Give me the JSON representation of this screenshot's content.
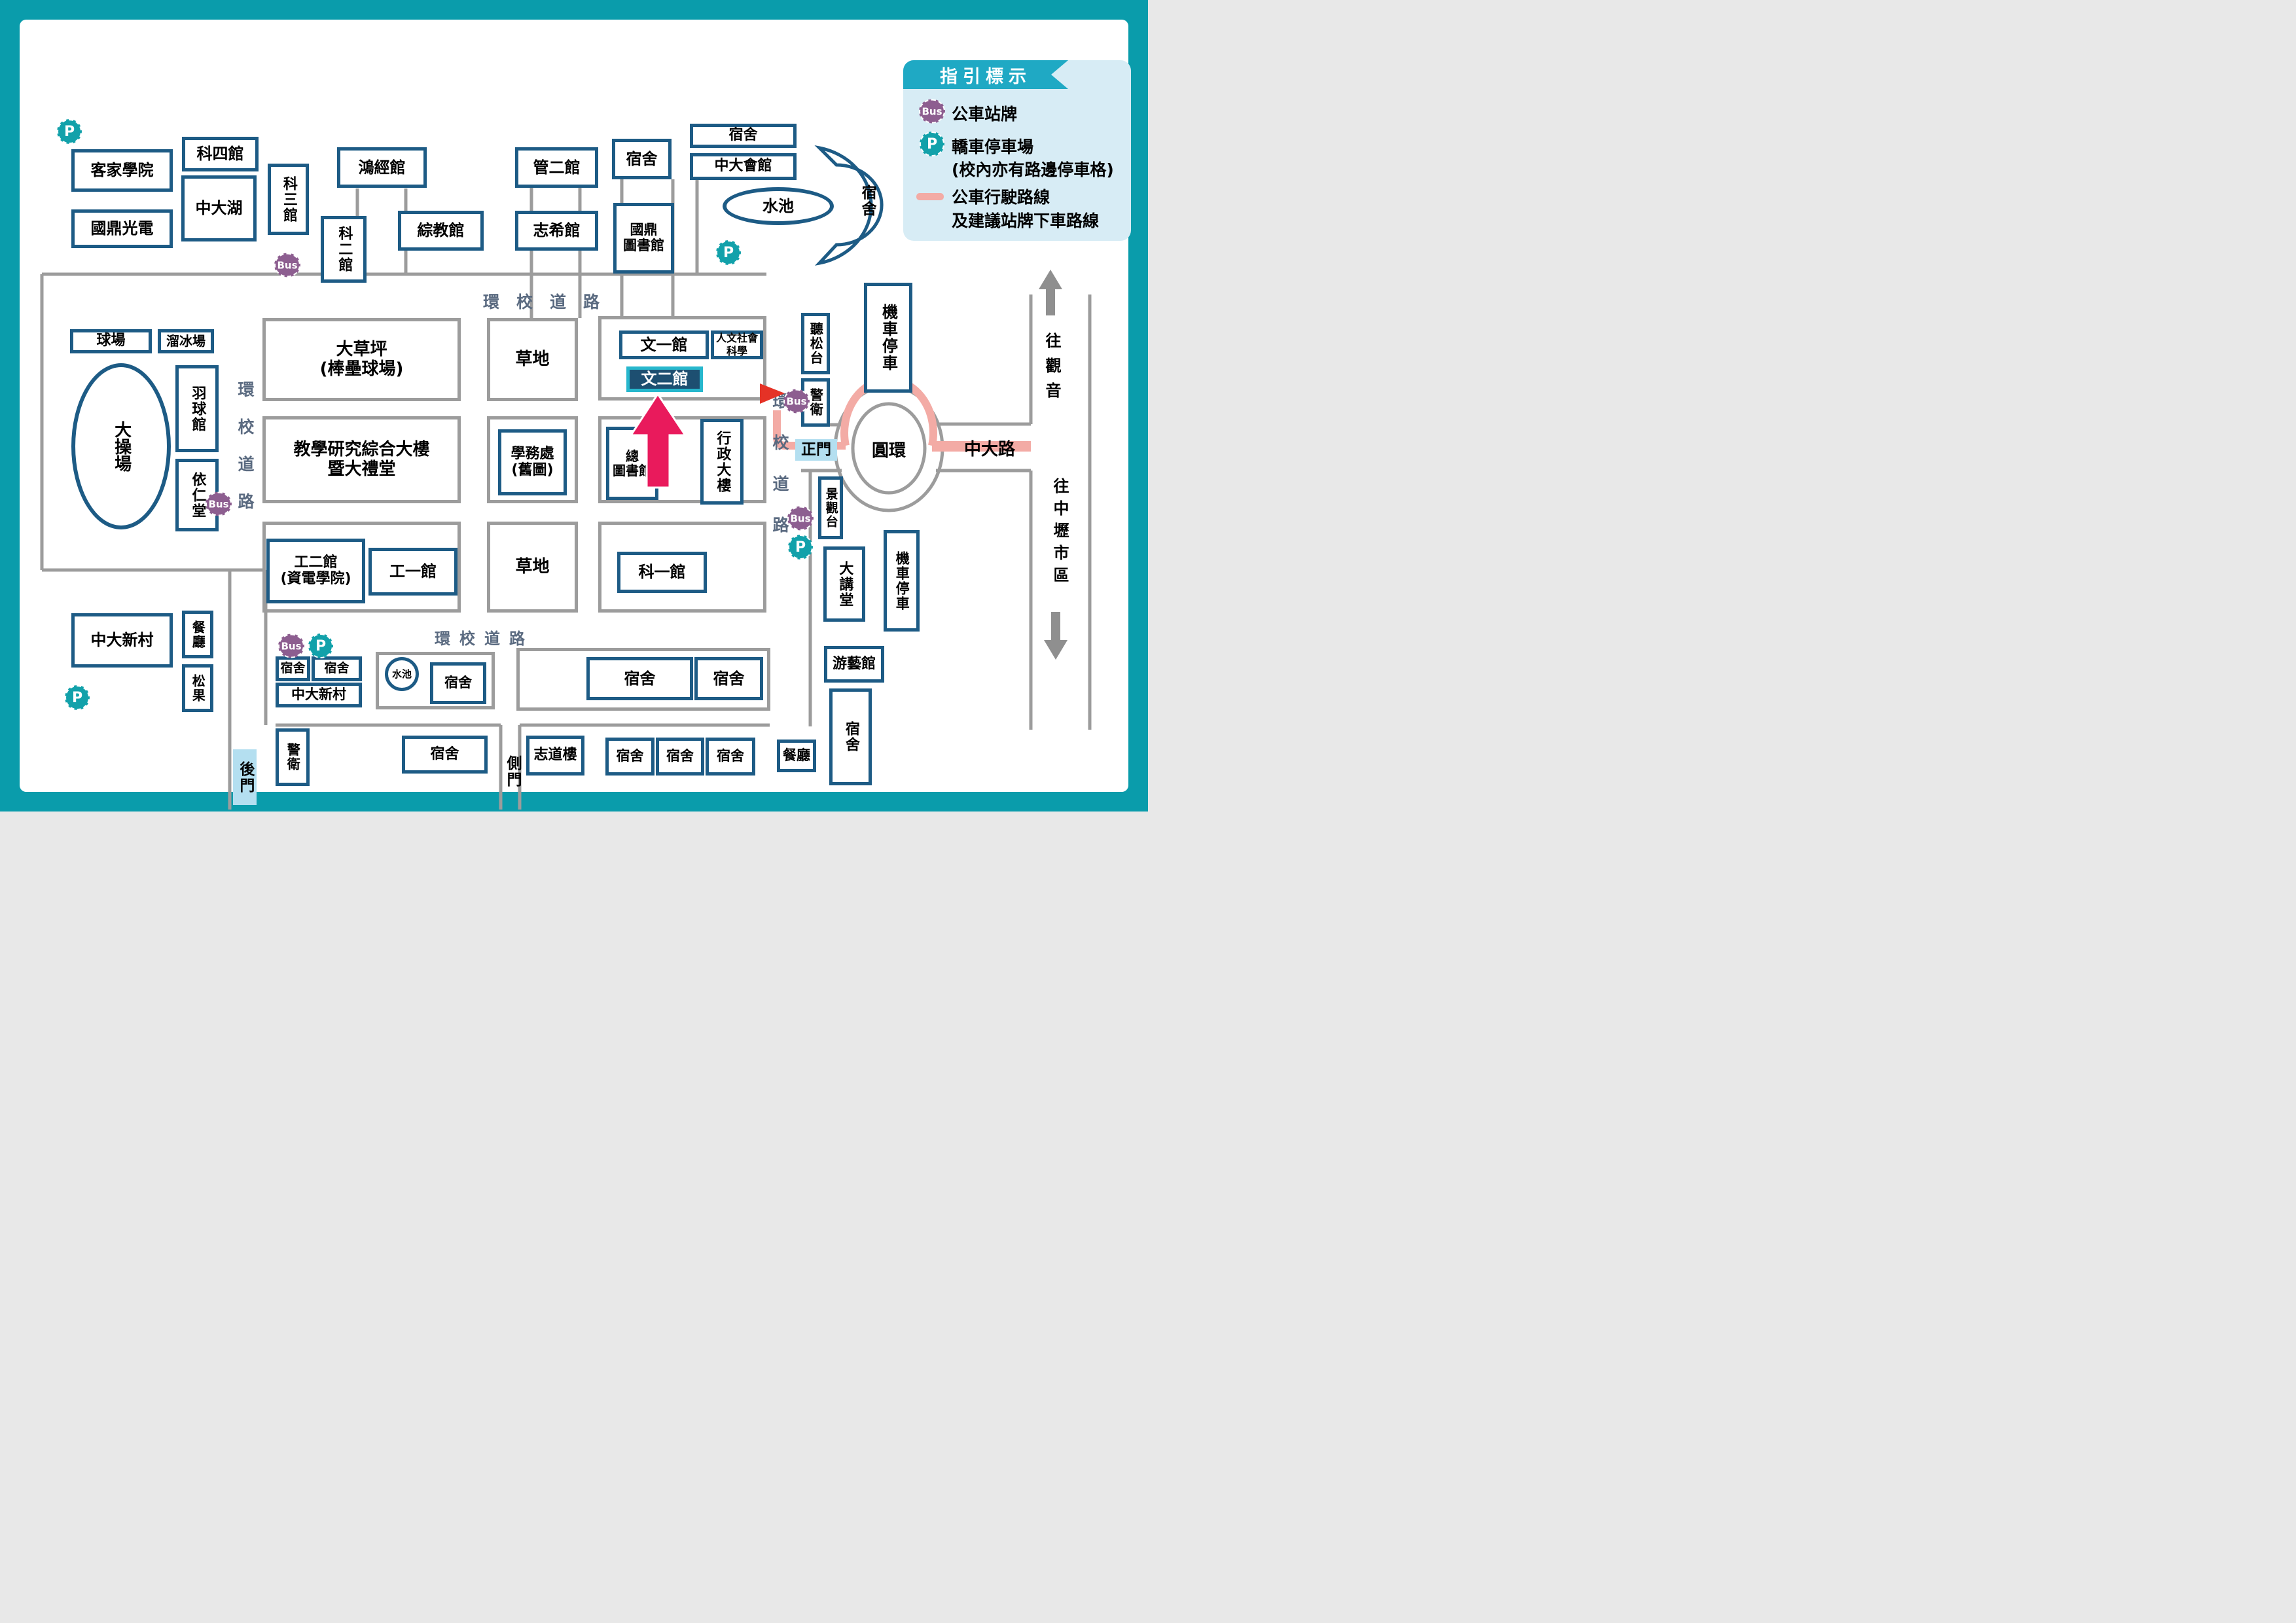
{
  "legend": {
    "title": "指引標示",
    "bus_icon": "Bus",
    "parking_icon": "P",
    "bus_label": "公車站牌",
    "parking_label": "轎車停車場",
    "parking_note": "(校內亦有路邊停車格)",
    "route_label_1": "公車行駛路線",
    "route_label_2": "及建議站牌下車路線"
  },
  "roads": {
    "ring_road": "環校道路",
    "ring_road_spaced": "環 校 道 路",
    "zhongda_road": "中大路",
    "roundabout": "圓環",
    "to_guanyin": "往觀音",
    "to_zhongli": "往中壢市區"
  },
  "gates": {
    "main": "正門",
    "back": "後門",
    "side": "側門"
  },
  "buildings": {
    "hakka": "客家學院",
    "kd_optics": "國鼎光電",
    "sci4": "科四館",
    "zhongda_lake": "中大湖",
    "sci3": "科三館",
    "sci2": "科二館",
    "hongjing": "鴻經館",
    "zongjiao": "綜教館",
    "mgmt2": "管二館",
    "zhixi": "志希館",
    "dorm": "宿舍",
    "kd_library": "國鼎\n圖書館",
    "zhongda_hall": "中大會館",
    "pond": "水池",
    "court": "球場",
    "skating": "溜冰場",
    "badminton": "羽球館",
    "playground": "大操場",
    "yiren": "依仁堂",
    "lawn_baseball": "大草坪\n(棒壘球場)",
    "grass": "草地",
    "wen1": "文一館",
    "hss": "人文社會科學",
    "wen2": "文二館",
    "tingsong": "聽松台",
    "guard": "警衛",
    "moto": "機車停車",
    "teaching": "教學研究綜合大樓\n暨大禮堂",
    "student_affairs": "學務處\n(舊圖)",
    "main_library": "總\n圖書館",
    "admin": "行政大樓",
    "eng2": "工二館\n(資電學院)",
    "eng1": "工一館",
    "sci1": "科一館",
    "lookout": "景觀台",
    "lecture_hall": "大講堂",
    "youyi": "游藝館",
    "restaurant": "餐廳",
    "zhongda_village": "中大新村",
    "songguo": "松果",
    "zhidao": "志道樓"
  },
  "colors": {
    "frame_teal": "#0a9cab",
    "legend_bg": "#d7ecf5",
    "legend_banner": "#1fa9c4",
    "building_border": "#1d5b85",
    "parcel_border": "#9c9c9c",
    "road_label": "#5a6a80",
    "bus_purple": "#8d5e90",
    "parking_teal": "#12a1aa",
    "route_pink": "#f3aba5",
    "gate_highlight": "#b4dff0",
    "target_fill": "#1d4f71",
    "target_border": "#27b7cd",
    "arrow_magenta": "#e91a5c",
    "marker_red": "#e53226"
  }
}
